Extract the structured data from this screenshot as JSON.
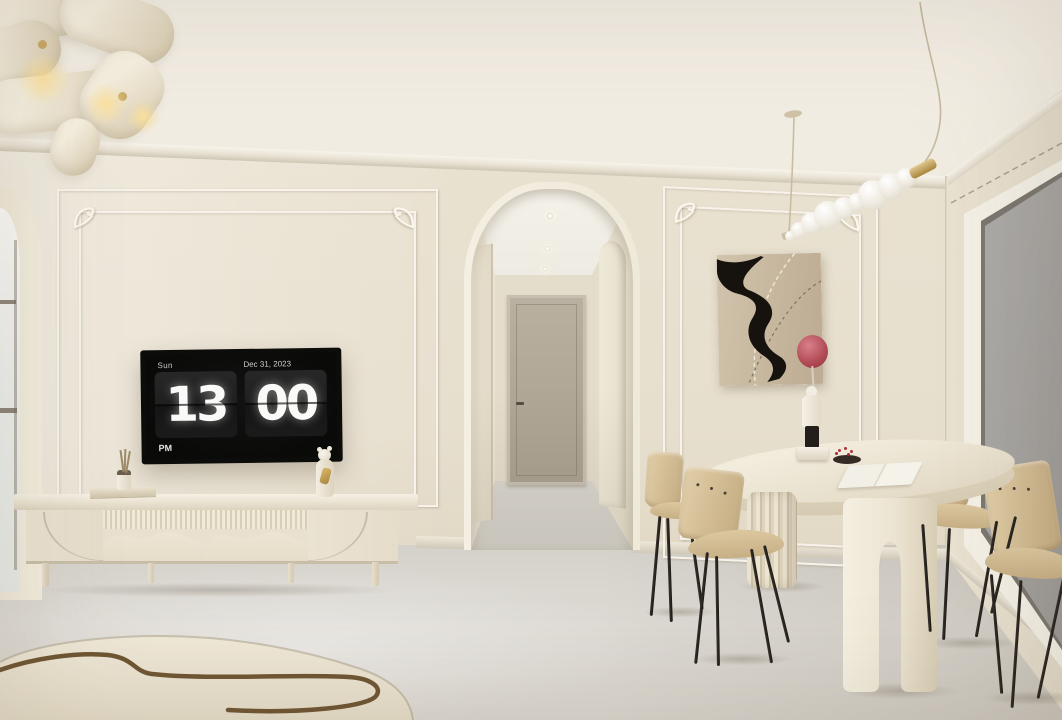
{
  "tv": {
    "day": "Sun",
    "date": "Dec 31, 2023",
    "hour": "13",
    "minute": "00",
    "meridiem": "PM"
  },
  "palette": {
    "wall": "#eae2d1",
    "ceiling": "#f4efe6",
    "molding": "#f7f3ea",
    "floor": "#dedbd5",
    "cream": "#ece5d4",
    "wood": "#c4ac82",
    "metal": "#1d1916",
    "tv_frame": "#0c0c0b",
    "tv_screen": "#0a0a09",
    "clock_text": "#fafaf8",
    "art_canvas": "#c8b9a1",
    "art_ink": "#16120e",
    "balloon": "#b04a55",
    "brass": "#a9853e",
    "glass": "#a6a4a1",
    "rug": "#ede6d4",
    "rug_line": "#6f5633",
    "hall_door": "#a89f8e"
  }
}
